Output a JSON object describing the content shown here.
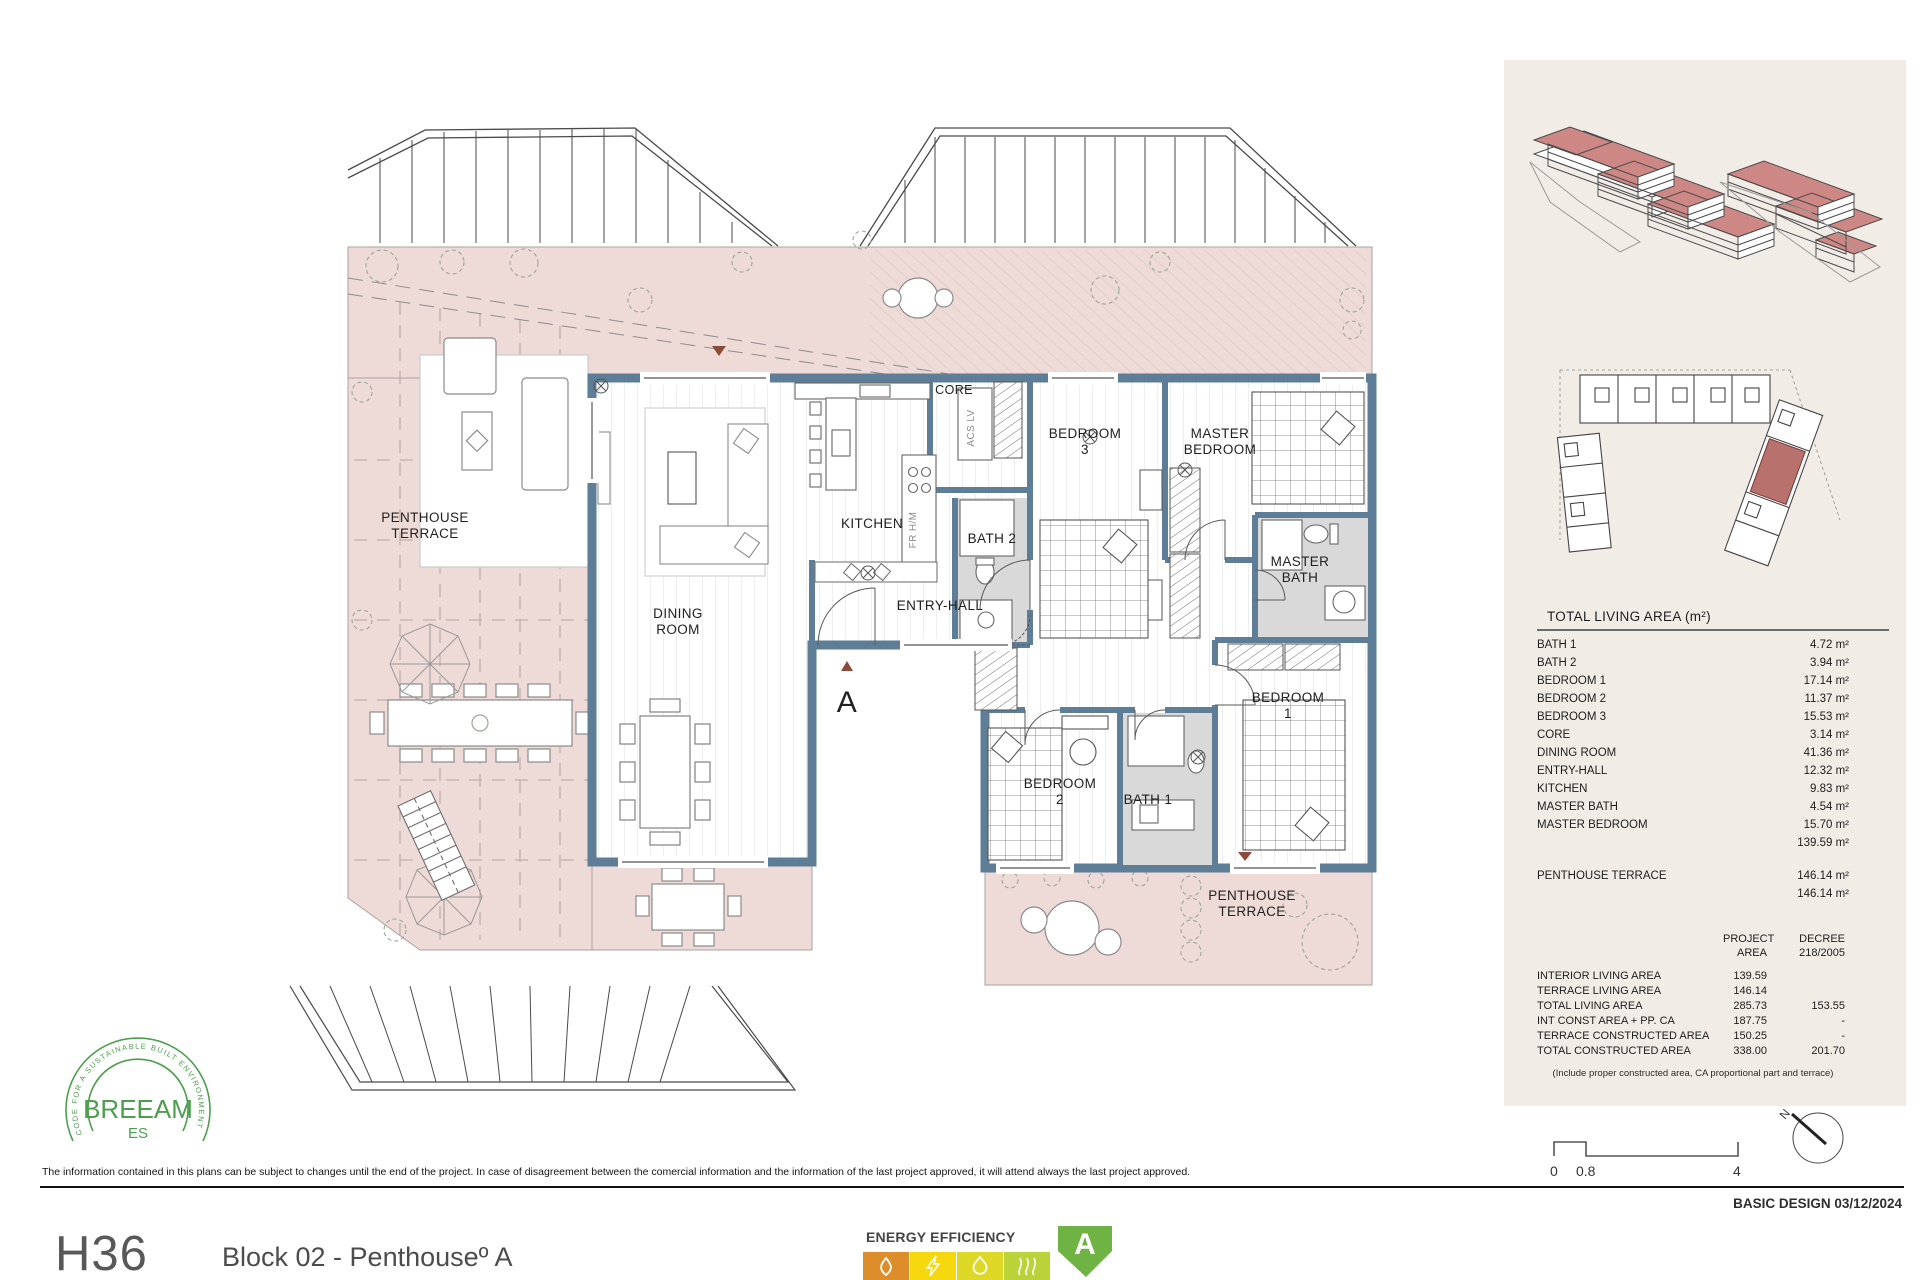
{
  "plan": {
    "rooms": {
      "terrace_left": {
        "l1": "PENTHOUSE",
        "l2": "TERRACE"
      },
      "dining": {
        "l1": "DINING",
        "l2": "ROOM"
      },
      "kitchen": "KITCHEN",
      "core": "CORE",
      "bath2": "BATH 2",
      "bedroom3": {
        "l1": "BEDROOM",
        "l2": "3"
      },
      "master_bedroom": {
        "l1": "MASTER",
        "l2": "BEDROOM"
      },
      "master_bath": {
        "l1": "MASTER",
        "l2": "BATH"
      },
      "entry_hall": "ENTRY-HALL",
      "bedroom1": {
        "l1": "BEDROOM",
        "l2": "1"
      },
      "bedroom2": {
        "l1": "BEDROOM",
        "l2": "2"
      },
      "bath1": "BATH 1",
      "terrace_right": {
        "l1": "PENTHOUSE",
        "l2": "TERRACE"
      },
      "closet1": "ACS LV",
      "closet2": "FR H/M",
      "section": "A"
    }
  },
  "sidebar": {
    "living": {
      "title": "TOTAL LIVING AREA (m²)",
      "rows": [
        {
          "name": "BATH 1",
          "value": "4.72 m²"
        },
        {
          "name": "BATH 2",
          "value": "3.94 m²"
        },
        {
          "name": "BEDROOM 1",
          "value": "17.14 m²"
        },
        {
          "name": "BEDROOM 2",
          "value": "11.37 m²"
        },
        {
          "name": "BEDROOM 3",
          "value": "15.53 m²"
        },
        {
          "name": "CORE",
          "value": "3.14 m²"
        },
        {
          "name": "DINING ROOM",
          "value": "41.36 m²"
        },
        {
          "name": "ENTRY-HALL",
          "value": "12.32 m²"
        },
        {
          "name": "KITCHEN",
          "value": "9.83 m²"
        },
        {
          "name": "MASTER BATH",
          "value": "4.54 m²"
        },
        {
          "name": "MASTER BEDROOM",
          "value": "15.70 m²"
        }
      ],
      "interior_total": "139.59 m²",
      "terrace_name": "PENTHOUSE TERRACE",
      "terrace_value": "146.14 m²",
      "terrace_total": "146.14 m²"
    },
    "summary": {
      "col_project_l1": "PROJECT",
      "col_project_l2": "AREA",
      "col_decree_l1": "DECREE",
      "col_decree_l2": "218/2005",
      "rows": [
        {
          "name": "INTERIOR LIVING AREA",
          "project": "139.59",
          "decree": ""
        },
        {
          "name": "TERRACE LIVING AREA",
          "project": "146.14",
          "decree": ""
        },
        {
          "name": "TOTAL LIVING AREA",
          "project": "285.73",
          "decree": "153.55"
        },
        {
          "name": "INT CONST AREA + PP. CA",
          "project": "187.75",
          "decree": "-"
        },
        {
          "name": "TERRACE CONSTRUCTED AREA",
          "project": "150.25",
          "decree": "-"
        },
        {
          "name": "TOTAL CONSTRUCTED AREA",
          "project": "338.00",
          "decree": "201.70"
        }
      ],
      "note": "(Include proper constructed area, CA proportional part and terrace)"
    },
    "scale": {
      "t0": "0",
      "t1": "0.8",
      "t2": "4"
    },
    "compass": "N"
  },
  "footer": {
    "disclaimer": "The information contained in this plans can be subject to changes until the end of the project. In case of disagreement between the comercial information and the information of the last project approved, it will attend always the last project approved.",
    "basic_design": "BASIC DESIGN 03/12/2024",
    "unit_code": "H36",
    "unit_title": "Block 02 -  Penthouseº A",
    "energy_label": "ENERGY EFFICIENCY",
    "energy_rating": "A",
    "breeam_arc": "CODE FOR A SUSTAINABLE BUILT ENVIRONMENT",
    "breeam_name": "BREEAM",
    "breeam_sub": "ES"
  },
  "colors": {
    "wall": "#5e7d97",
    "terrace_pink": "#eedad7",
    "panel_beige": "#f2ece7",
    "bath_floor": "#d9d9d9",
    "roof_red": "#cd8784",
    "marker_red": "#8d4a3a",
    "breeam_green": "#4d9e4f",
    "energy_orange": "#dd8d2a",
    "energy_yellow": "#f6d80e",
    "energy_lime": "#dcd825",
    "energy_yellowgreen": "#bcd239",
    "energy_green": "#6fb345"
  }
}
